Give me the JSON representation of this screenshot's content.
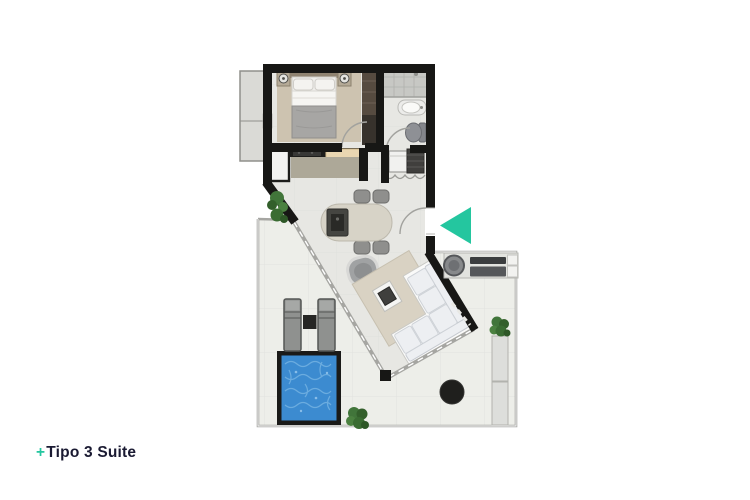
{
  "label": {
    "plus": "+",
    "title": "Tipo 3 Suite"
  },
  "nav": {
    "arrow_direction": "left"
  },
  "colors": {
    "accent": "#24c69f",
    "label_text": "#1a1a32",
    "wall": "#171715",
    "floor": "#e7e7e3",
    "terrace_floor": "#edeee9",
    "bedroom_rug": "#cdc3b0",
    "living_rug": "#d9d2c3",
    "pool_water": "#3c8bd0",
    "plant": "#41753a",
    "sofa": "#edeff2",
    "counter": "#ada898",
    "board": "#e9d6b1"
  }
}
